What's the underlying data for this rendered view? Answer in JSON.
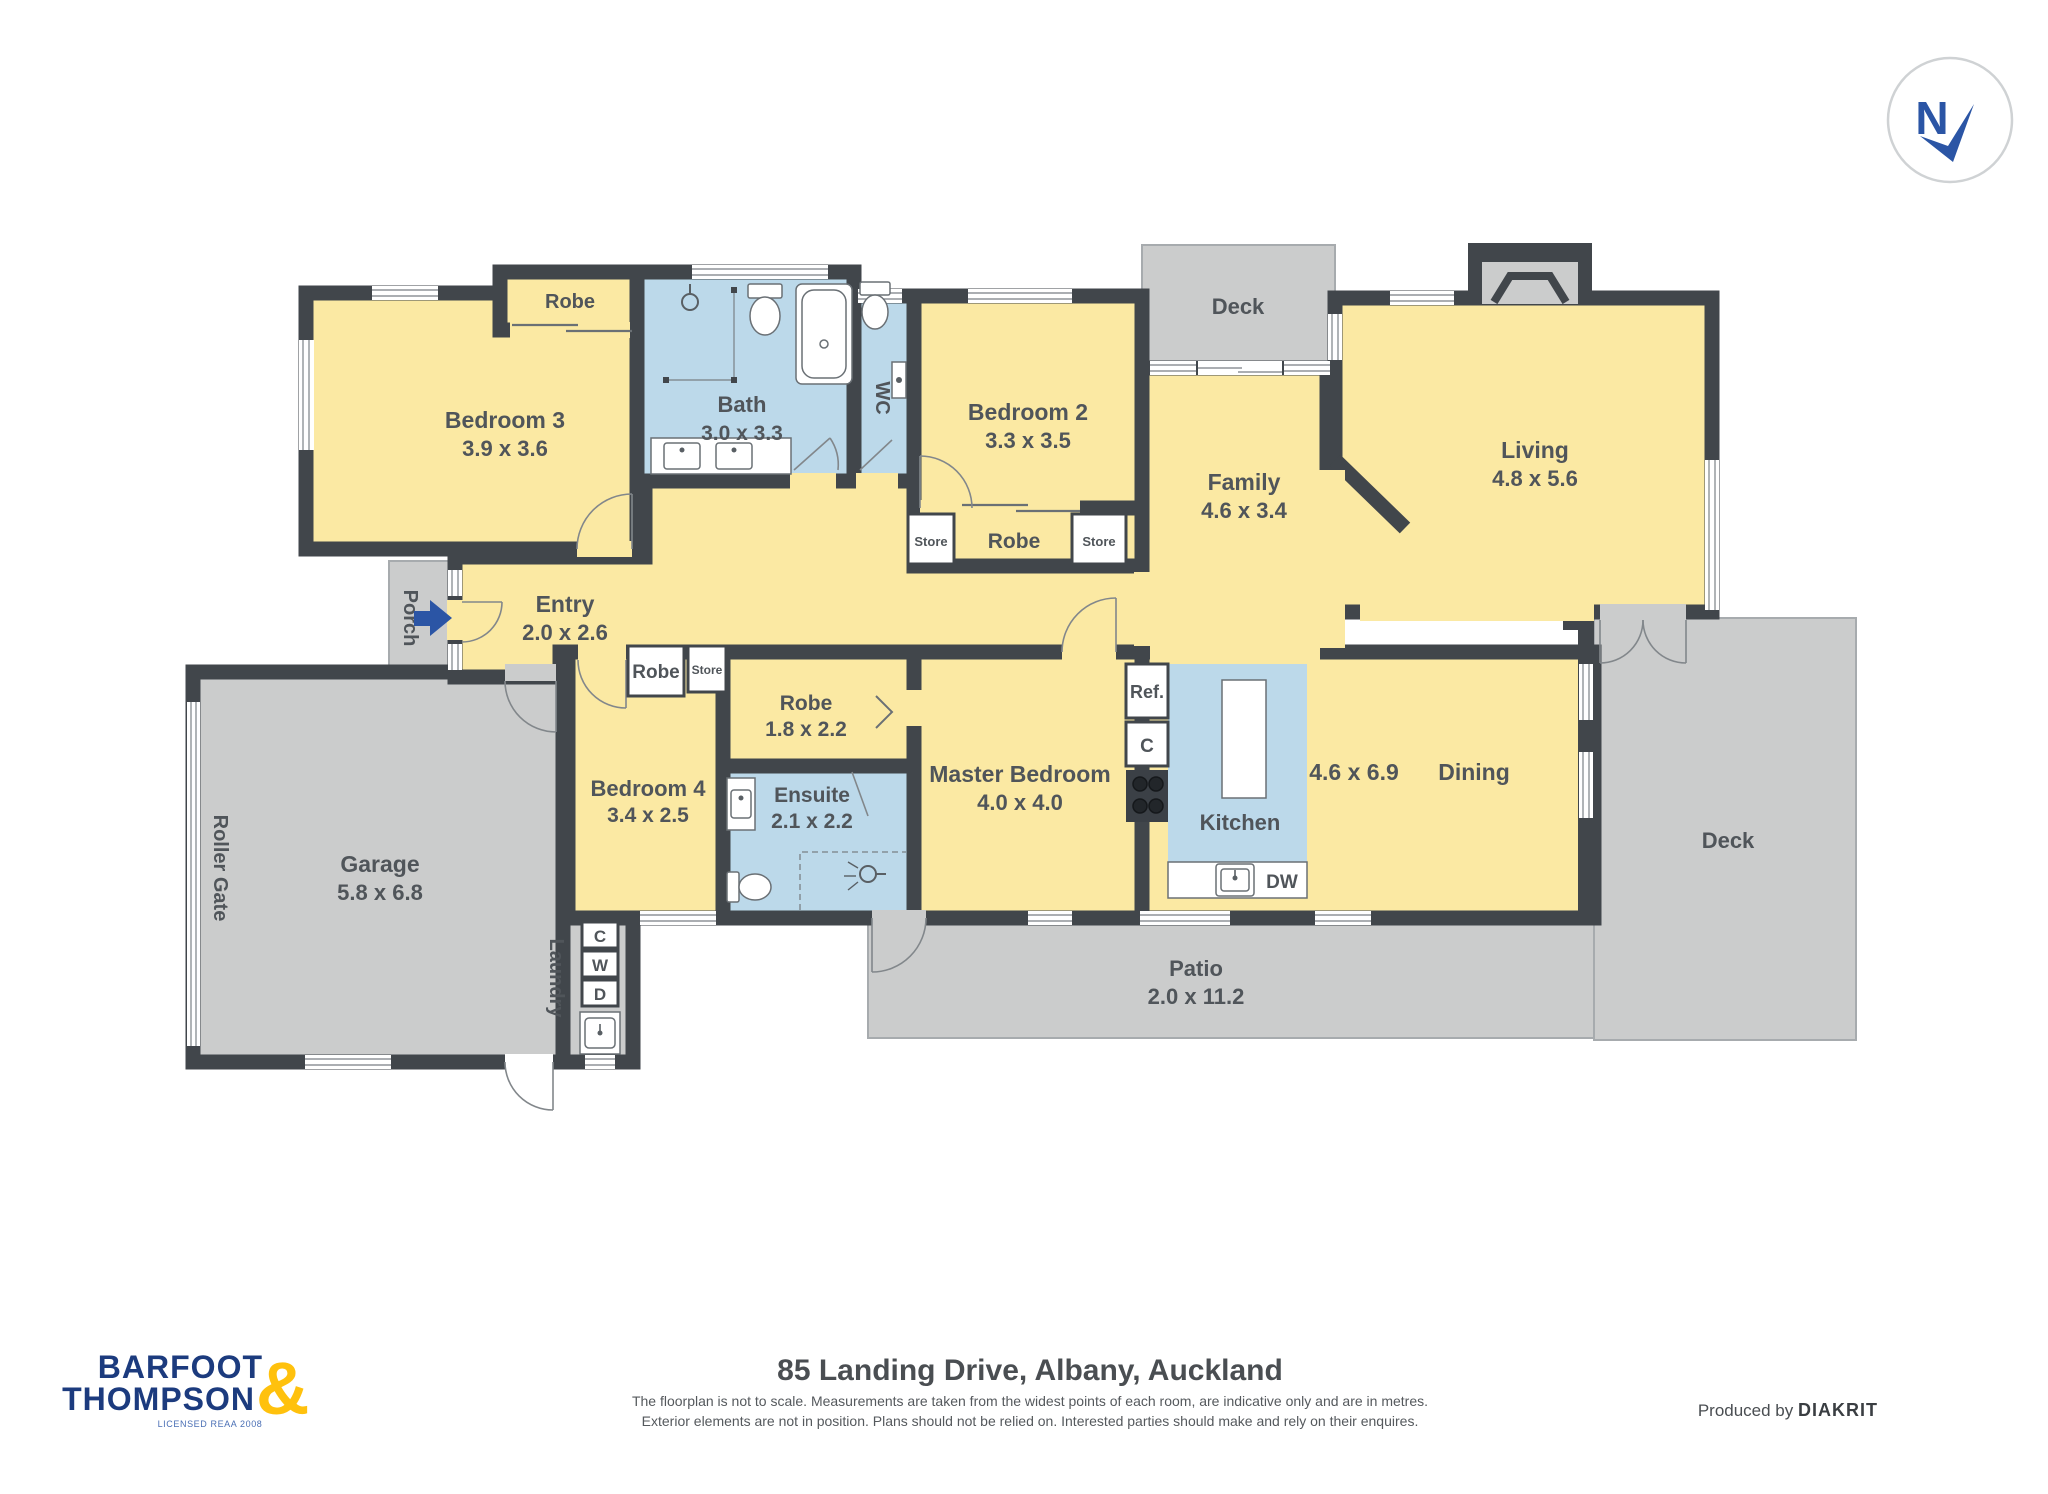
{
  "page": {
    "width": 2048,
    "height": 1494,
    "background": "#ffffff"
  },
  "title_block": {
    "address": "85 Landing Drive, Albany, Auckland",
    "disclaimer_line1": "The floorplan is not to scale. Measurements are taken from the widest points of each room, are indicative only and are in metres.",
    "disclaimer_line2": "Exterior elements are not in position. Plans should not be relied on. Interested parties should make and rely on their enquires.",
    "produced_by_label": "Produced by ",
    "producer_name": "DIAKRIT"
  },
  "brand": {
    "word1": "BARFOOT",
    "ampersand": "&",
    "word2": "THOMPSON",
    "tagline": "LICENSED REAA 2008"
  },
  "compass": {
    "label": "N"
  },
  "rooms": {
    "bedroom3": {
      "name": "Bedroom 3",
      "dims": "3.9 x 3.6"
    },
    "robe_bed3": {
      "name": "Robe"
    },
    "bath": {
      "name": "Bath",
      "dims": "3.0 x 3.3"
    },
    "wc": {
      "name": "WC"
    },
    "bedroom2": {
      "name": "Bedroom 2",
      "dims": "3.3 x 3.5"
    },
    "store_a": {
      "name": "Store"
    },
    "robe_bed2": {
      "name": "Robe"
    },
    "store_b": {
      "name": "Store"
    },
    "deck_top": {
      "name": "Deck"
    },
    "family": {
      "name": "Family",
      "dims": "4.6 x 3.4"
    },
    "living": {
      "name": "Living",
      "dims": "4.8 x 5.6"
    },
    "entry": {
      "name": "Entry",
      "dims": "2.0 x 2.6"
    },
    "porch": {
      "name": "Porch"
    },
    "robe_bed4": {
      "name": "Robe"
    },
    "store_c": {
      "name": "Store"
    },
    "robe_master": {
      "name": "Robe",
      "dims": "1.8 x 2.2"
    },
    "ensuite": {
      "name": "Ensuite",
      "dims": "2.1 x 2.2"
    },
    "master": {
      "name": "Master Bedroom",
      "dims": "4.0 x 4.0"
    },
    "bedroom4": {
      "name": "Bedroom 4",
      "dims": "3.4 x 2.5"
    },
    "kitchen": {
      "name": "Kitchen"
    },
    "openplan": {
      "dims": "4.6 x 6.9"
    },
    "dining": {
      "name": "Dining"
    },
    "deck_right": {
      "name": "Deck"
    },
    "patio": {
      "name": "Patio",
      "dims": "2.0 x 11.2"
    },
    "garage": {
      "name": "Garage",
      "dims": "5.8 x 6.8"
    },
    "roller_gate": {
      "name": "Roller Gate"
    },
    "laundry": {
      "name": "Laundry"
    }
  },
  "appliances": {
    "fridge": "Ref.",
    "cupboard": "C",
    "dishwasher": "DW",
    "laundry_c": "C",
    "laundry_w": "W",
    "laundry_d": "D"
  },
  "colors": {
    "floor_yellow": "#FBE9A3",
    "wet_area_blue": "#BCD9EA",
    "outdoor_gray": "#CBCCCC",
    "wall_dark": "#41464B",
    "accent_blue": "#2B55A5",
    "logo_blue": "#1C3B7E",
    "logo_yellow": "#FFC10D",
    "label_gray": "#50555A"
  }
}
